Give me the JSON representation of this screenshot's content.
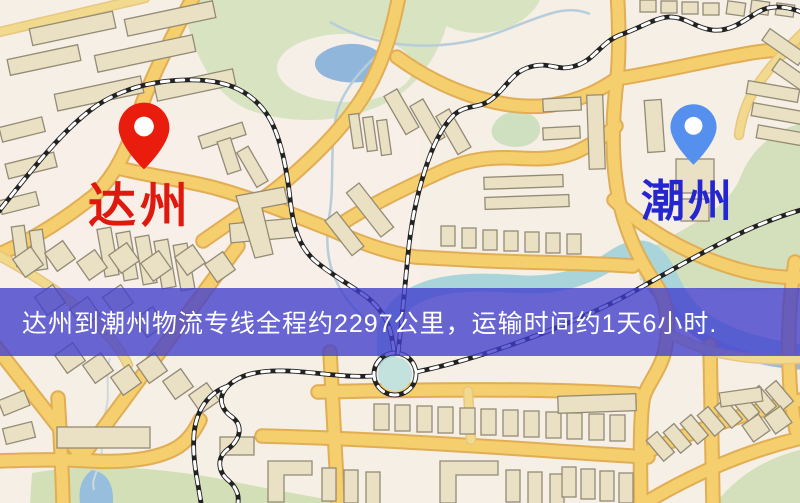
{
  "map": {
    "type": "road-map-screenshot",
    "markers": {
      "origin": {
        "label": "达州",
        "pin_color": "#ea1c0d",
        "label_color": "#e0190e"
      },
      "destination": {
        "label": "潮州",
        "pin_color": "#5590ee",
        "label_color": "#2626d0"
      }
    },
    "banner": {
      "text": "达州到潮州物流专线全程约2297公里，运输时间约1天6小时.",
      "bg_color": "rgba(64,62,205,0.78)",
      "text_color": "#ffffff"
    },
    "palette": {
      "background": "#f6efe5",
      "road_fill": "#f6ce6a",
      "road_casing": "#e2ad52",
      "minor_road": "#f2d98c",
      "building": "#eae1c4",
      "building_outline": "#938b74",
      "park": "#d8e4c0",
      "lake": "#8fb6dc",
      "river": "#a8d4da",
      "rail_dark": "#222222",
      "rail_light": "#ffffff"
    }
  }
}
